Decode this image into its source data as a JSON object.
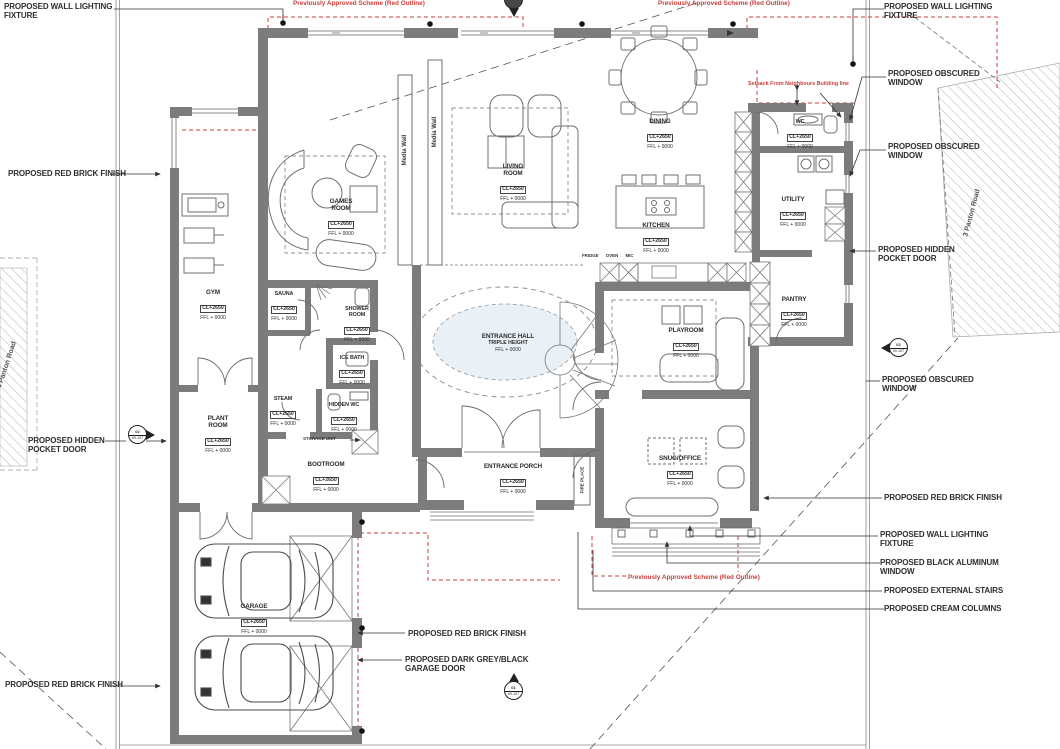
{
  "drawing_type": "ground-floor-plan",
  "colors": {
    "wall": "#7c7c7c",
    "red_annotation": "#c4433e",
    "line": "#666666",
    "hatch": "#b5b5b5"
  },
  "red_notes": {
    "approved_scheme": "Previously Approved Scheme (Red Outline)",
    "setback": "Setback From Neighbours Building line"
  },
  "roads": {
    "right": "3 Panton Road",
    "left": "4 Panton Road"
  },
  "callouts": [
    {
      "text": "PROPOSED WALL LIGHTING FIXTURE"
    },
    {
      "text": "PROPOSED WALL LIGHTING FIXTURE"
    },
    {
      "text": "PROPOSED OBSCURED WINDOW"
    },
    {
      "text": "PROPOSED OBSCURED WINDOW"
    },
    {
      "text": "PROPOSED HIDDEN POCKET DOOR"
    },
    {
      "text": "PROPOSED OBSCURED WINDOW"
    },
    {
      "text": "PROPOSED RED BRICK FINISH"
    },
    {
      "text": "PROPOSED WALL LIGHTING FIXTURE"
    },
    {
      "text": "PROPOSED BLACK ALUMINUM WINDOW"
    },
    {
      "text": "PROPOSED EXTERNAL STAIRS"
    },
    {
      "text": "PROPOSED CREAM COLUMNS"
    },
    {
      "text": "PROPOSED RED BRICK FINISH"
    },
    {
      "text": "PROPOSED HIDDEN POCKET DOOR"
    },
    {
      "text": "PROPOSED RED BRICK FINISH"
    },
    {
      "text": "PROPOSED RED BRICK FINISH"
    },
    {
      "text": "PROPOSED DARK GREY/BLACK GARAGE DOOR"
    }
  ],
  "rooms": [
    {
      "name": "GYM",
      "cl": "CL+2650",
      "ffl": "FFL + 0000"
    },
    {
      "name": "GAMES ROOM",
      "cl": "CL+2650",
      "ffl": "FFL + 0000"
    },
    {
      "name": "SAUNA",
      "cl": "CL+2650",
      "ffl": "FFL + 0000"
    },
    {
      "name": "SHOWER ROOM",
      "cl": "CL+2650",
      "ffl": "FFL + 0000"
    },
    {
      "name": "ICE BATH",
      "cl": "CL+2650",
      "ffl": "FFL + 0000"
    },
    {
      "name": "STEAM",
      "cl": "CL+2650",
      "ffl": "FFL + 0000"
    },
    {
      "name": "HIDDEN WC",
      "cl": "CL+2650",
      "ffl": "FFL + 0000"
    },
    {
      "name": "PLANT ROOM",
      "cl": "CL+2650",
      "ffl": "FFL + 0000"
    },
    {
      "name": "BOOTROOM",
      "cl": "CL+2650",
      "ffl": "FFL + 0000"
    },
    {
      "name": "LIVING ROOM",
      "cl": "CL+2650",
      "ffl": "FFL + 0000"
    },
    {
      "name": "DINING",
      "cl": "CL+2650",
      "ffl": "FFL + 0000"
    },
    {
      "name": "KITCHEN",
      "cl": "CL+2650",
      "ffl": "FFL + 0000"
    },
    {
      "name": "WC",
      "cl": "CL+2650",
      "ffl": "FFL + 0000"
    },
    {
      "name": "UTILITY",
      "cl": "CL+2650",
      "ffl": "FFL + 0000"
    },
    {
      "name": "PANTRY",
      "cl": "CL+2650",
      "ffl": "FFL + 0000"
    },
    {
      "name": "PLAYROOM",
      "cl": "CL+2650",
      "ffl": "FFL + 0000"
    },
    {
      "name": "SNUG/OFFICE",
      "cl": "CL+2650",
      "ffl": "FFL + 0000"
    },
    {
      "name": "ENTRANCE PORCH",
      "cl": "CL+2650",
      "ffl": "FFL + 0000"
    },
    {
      "name": "GARAGE",
      "cl": "CL+2650",
      "ffl": "FFL + 0000"
    },
    {
      "name": "ENTRANCE HALL",
      "note": "TRIPLE HEIGHT",
      "ffl": "FFL + 0000"
    }
  ],
  "fixtures": {
    "media_wall": "Media Wall",
    "fire_place": "FIRE PLACE",
    "storage_unit": "STORAGE UNIT",
    "appliance_row": "FRIDGE OVEN MIC"
  },
  "markers": [
    {
      "num": "02",
      "sheet": "00-107"
    },
    {
      "num": "02",
      "sheet": "00-107"
    },
    {
      "num": "01",
      "sheet": "00-107"
    },
    {
      "num": "",
      "sheet": "00-107"
    }
  ]
}
